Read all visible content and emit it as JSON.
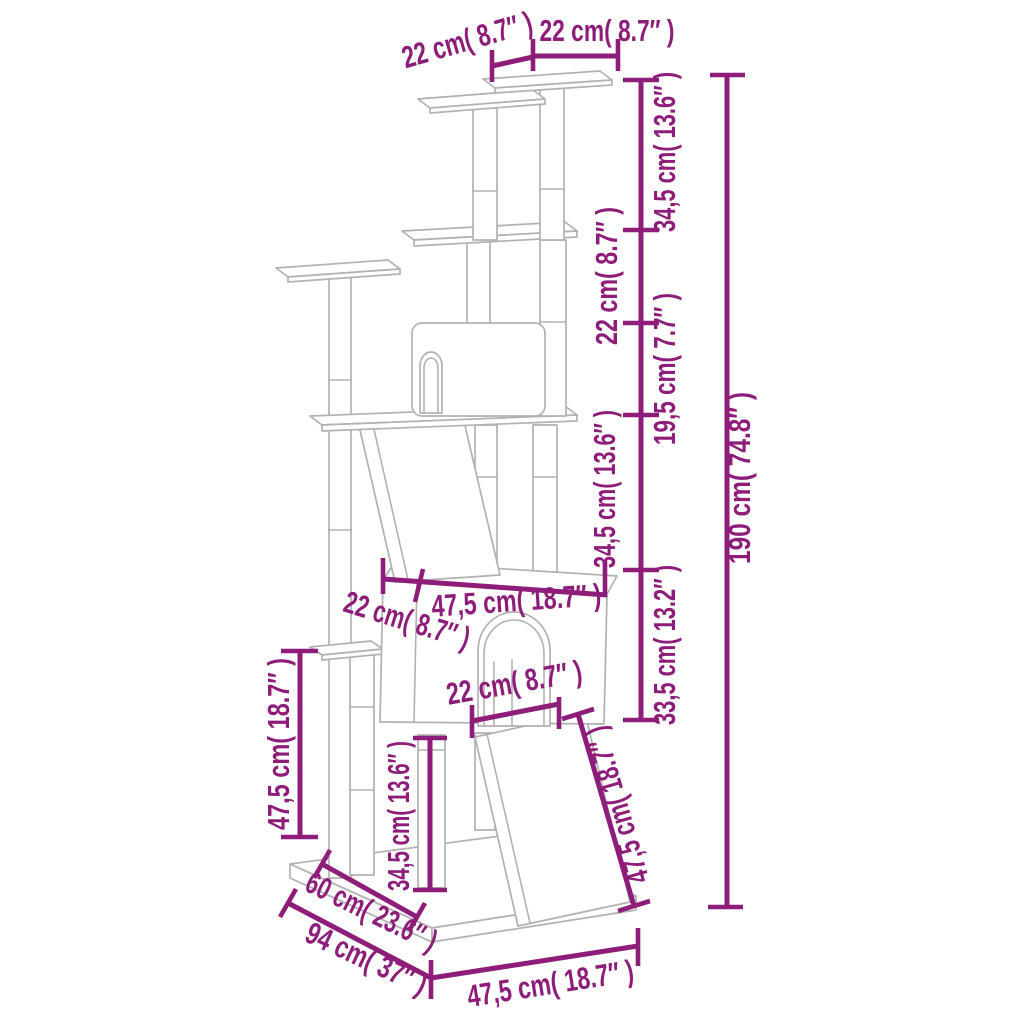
{
  "figure": {
    "kind": "product dimension diagram",
    "subject": "cat tree with scratching posts – line drawing",
    "accent_color": "#8e1d7a",
    "line_art_color": "#b3b0b3"
  },
  "dimensions": {
    "top_platform_depth": "22 cm( 8.7″ )",
    "top_platform_width": "22 cm( 8.7″ )",
    "right_segments": [
      "34,5 cm( 13.6″ )",
      "22 cm( 8.7″ )",
      "19,5 cm( 7.7″ )",
      "34,5 cm( 13.6″ )",
      "33,5 cm( 13.2″ )"
    ],
    "total_height": "190 cm( 74.8″ )",
    "condo_depth": "22 cm( 8.7″ )",
    "condo_width": "47,5 cm( 18.7″ )",
    "door_width": "22 cm( 8.7″ )",
    "left_post_height": "47,5 cm( 18.7″ )",
    "front_post_height": "34,5 cm( 13.6″ )",
    "ramp_length": "47,5 cm( 18.7″ )",
    "base_inner_depth": "60 cm( 23.6″ )",
    "base_depth": "94 cm( 37″ )",
    "base_width": "47,5 cm( 18.7″ )"
  }
}
